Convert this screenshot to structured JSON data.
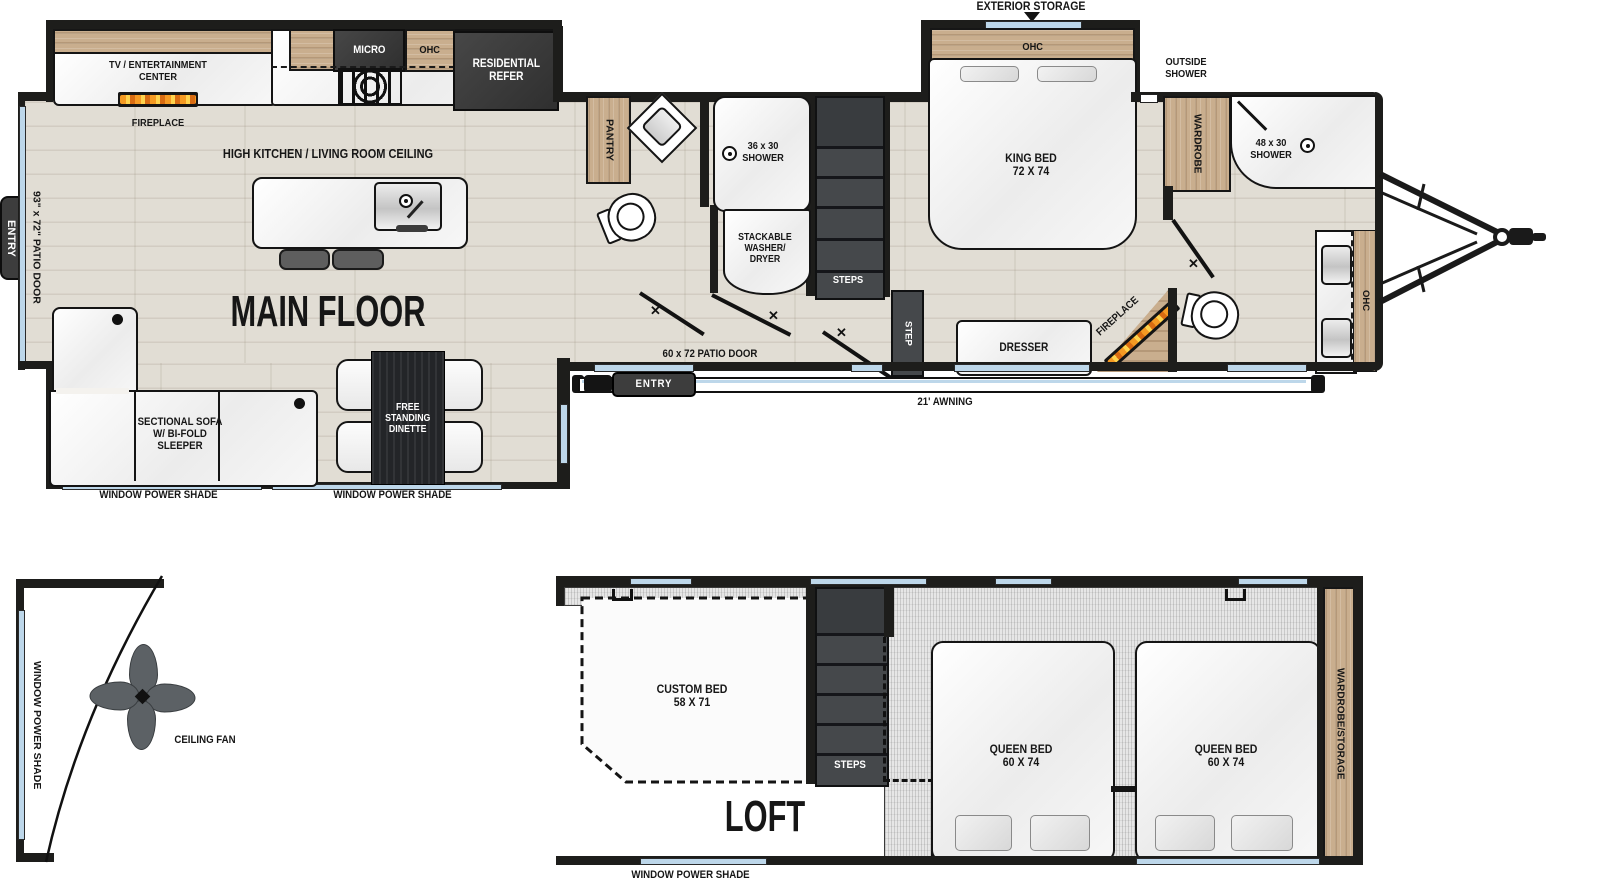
{
  "colors": {
    "wall": "#1d1d1b",
    "wood_cabinet": "#c9ae8e",
    "dark_fixture": "#3f4245",
    "window_glass": "#bdd7ea",
    "floor_wood": "#e1ddd4",
    "carpet": "#e6e6e6",
    "flame_accent": "#f59a23"
  },
  "icons": {
    "door_x": "✕"
  },
  "main_floor": {
    "title": "MAIN FLOOR",
    "ceiling_label": "HIGH KITCHEN / LIVING ROOM CEILING",
    "tv_center": "TV / ENTERTAINMENT\nCENTER",
    "fireplace": "FIREPLACE",
    "micro": "MICRO",
    "ohc": "OHC",
    "refer": "RESIDENTIAL\nREFER",
    "pantry": "PANTRY",
    "patio_door_left": "93\" x 72\" PATIO DOOR",
    "entry": "ENTRY",
    "sectional": "SECTIONAL SOFA\nW/ BI-FOLD\nSLEEPER",
    "dinette": "FREE\nSTANDING\nDINETTE",
    "window_shade": "WINDOW POWER SHADE",
    "shower_36": "36 x 30\nSHOWER",
    "washer_dryer": "STACKABLE\nWASHER/\nDRYER",
    "steps": "STEPS",
    "step": "STEP",
    "patio_door_60": "60 x 72 PATIO DOOR",
    "awning": "21' AWNING",
    "exterior_storage": "EXTERIOR STORAGE",
    "king_bed": "KING BED\n72 X 74",
    "outside_shower": "OUTSIDE\nSHOWER",
    "wardrobe": "WARDROBE",
    "shower_48": "48 x 30\nSHOWER",
    "dresser": "DRESSER"
  },
  "loft": {
    "title": "LOFT",
    "custom_bed": "CUSTOM BED\n58 X 71",
    "steps": "STEPS",
    "queen_bed": "QUEEN BED\n60 X 74",
    "wardrobe_storage": "WARDROBE/STORAGE",
    "window_shade": "WINDOW POWER SHADE"
  },
  "front_cap": {
    "window_shade": "WINDOW POWER SHADE",
    "ceiling_fan": "CEILING FAN"
  }
}
